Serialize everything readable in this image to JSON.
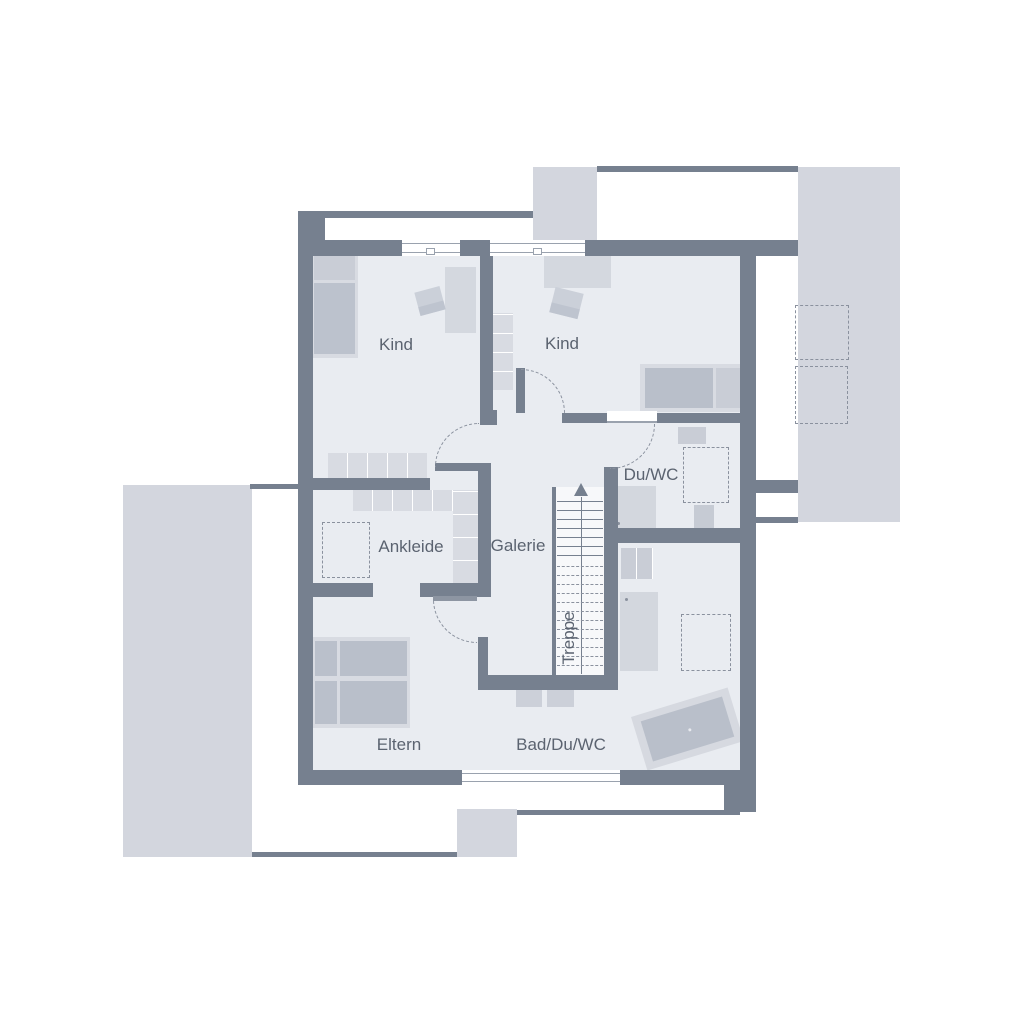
{
  "floor_plan": {
    "rooms": {
      "kind1": {
        "label": "Kind"
      },
      "kind2": {
        "label": "Kind"
      },
      "duwc": {
        "label": "Du/WC"
      },
      "ankleide": {
        "label": "Ankleide"
      },
      "galerie": {
        "label": "Galerie"
      },
      "treppe": {
        "label": "Treppe"
      },
      "eltern": {
        "label": "Eltern"
      },
      "bad": {
        "label": "Bad/Du/WC"
      }
    },
    "colors": {
      "wall": "#76808f",
      "floor": "#e9ecf1",
      "outdoor_block": "#d3d6de",
      "furniture_light": "#d8dbe2",
      "furniture_mid": "#c9cdd6",
      "furniture_dark": "#b9bfca",
      "dashed_outline": "#8a919e",
      "label_text": "#5b6370",
      "stair_area": "#f7f8fa"
    }
  }
}
